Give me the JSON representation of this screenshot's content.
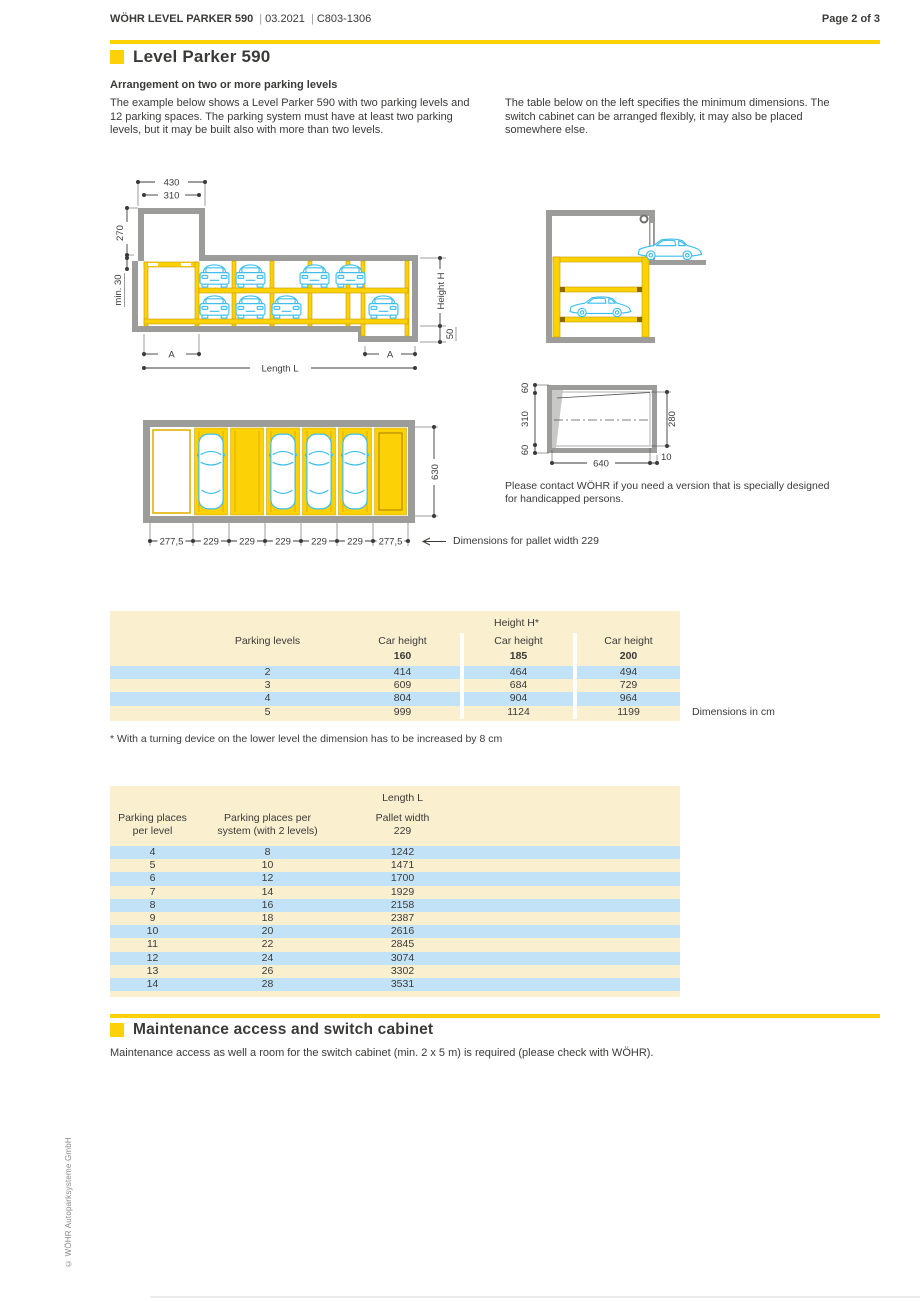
{
  "header": {
    "brand": "WÖHR LEVEL PARKER 590",
    "separator": "|",
    "date": "03.2021",
    "code": "C803-1306",
    "page": "Page 2 of 3"
  },
  "section1": {
    "title": "Level Parker 590",
    "subheading": "Arrangement on two or more parking levels",
    "para_left": "The example below shows a Level Parker 590 with two parking levels and 12 parking spaces. The parking system must have at least two parking levels, but it may be built also with more than two levels.",
    "para_right": "The table below on the left specifies the minimum dimensions. The switch cabinet can be arranged flexibly, it may also be placed somewhere else."
  },
  "diagrams": {
    "side_view": {
      "dim_430": "430",
      "dim_310": "310",
      "dim_270": "270",
      "dim_min30": "min. 30",
      "dim_height": "Height H",
      "dim_50": "50",
      "dim_a_left": "A",
      "dim_a_right": "A",
      "dim_length": "Length L"
    },
    "space_view": {
      "dim_60_top": "60",
      "dim_310": "310",
      "dim_60_bottom": "60",
      "dim_640": "640",
      "dim_10": "10",
      "dim_280": "280"
    },
    "plan_view": {
      "dims": [
        "277,5",
        "229",
        "229",
        "229",
        "229",
        "229",
        "277,5"
      ],
      "dim_630": "630",
      "note": "Dimensions for pallet width 229"
    },
    "handicap_note": "Please contact WÖHR if you need a version that is specially designed for handicapped persons."
  },
  "table1": {
    "group_header": "Height H*",
    "col_levels": "Parking levels",
    "car_height": "Car height",
    "heights": [
      "160",
      "185",
      "200"
    ],
    "rows": [
      [
        "2",
        "414",
        "464",
        "494"
      ],
      [
        "3",
        "609",
        "684",
        "729"
      ],
      [
        "4",
        "804",
        "904",
        "964"
      ],
      [
        "5",
        "999",
        "1124",
        "1199"
      ]
    ],
    "unit_note": "Dimensions in cm",
    "footnote": "*  With a turning device on the lower level the dimension has to be increased by 8 cm"
  },
  "table2": {
    "group_header": "Length L",
    "col1_l1": "Parking places",
    "col1_l2": "per level",
    "col2_l1": "Parking places per",
    "col2_l2": "system (with 2 levels)",
    "col3_l1": "Pallet width",
    "col3_l2": "229",
    "rows": [
      [
        "4",
        "8",
        "1242"
      ],
      [
        "5",
        "10",
        "1471"
      ],
      [
        "6",
        "12",
        "1700"
      ],
      [
        "7",
        "14",
        "1929"
      ],
      [
        "8",
        "16",
        "2158"
      ],
      [
        "9",
        "18",
        "2387"
      ],
      [
        "10",
        "20",
        "2616"
      ],
      [
        "11",
        "22",
        "2845"
      ],
      [
        "12",
        "24",
        "3074"
      ],
      [
        "13",
        "26",
        "3302"
      ],
      [
        "14",
        "28",
        "3531"
      ]
    ]
  },
  "section2": {
    "title": "Maintenance access and switch cabinet",
    "body": "Maintenance access as well a room for the switch cabinet (min. 2 x 5 m) is required (please check with WÖHR)."
  },
  "footer": {
    "copyright": "© WÖHR Autoparksysteme GmbH"
  },
  "colors": {
    "accent_yellow": "#fcd105",
    "wall_gray": "#9c9c9b",
    "car_blue": "#3fbeee",
    "table_cream": "#faefcf",
    "table_blue": "#c2e3f7"
  }
}
